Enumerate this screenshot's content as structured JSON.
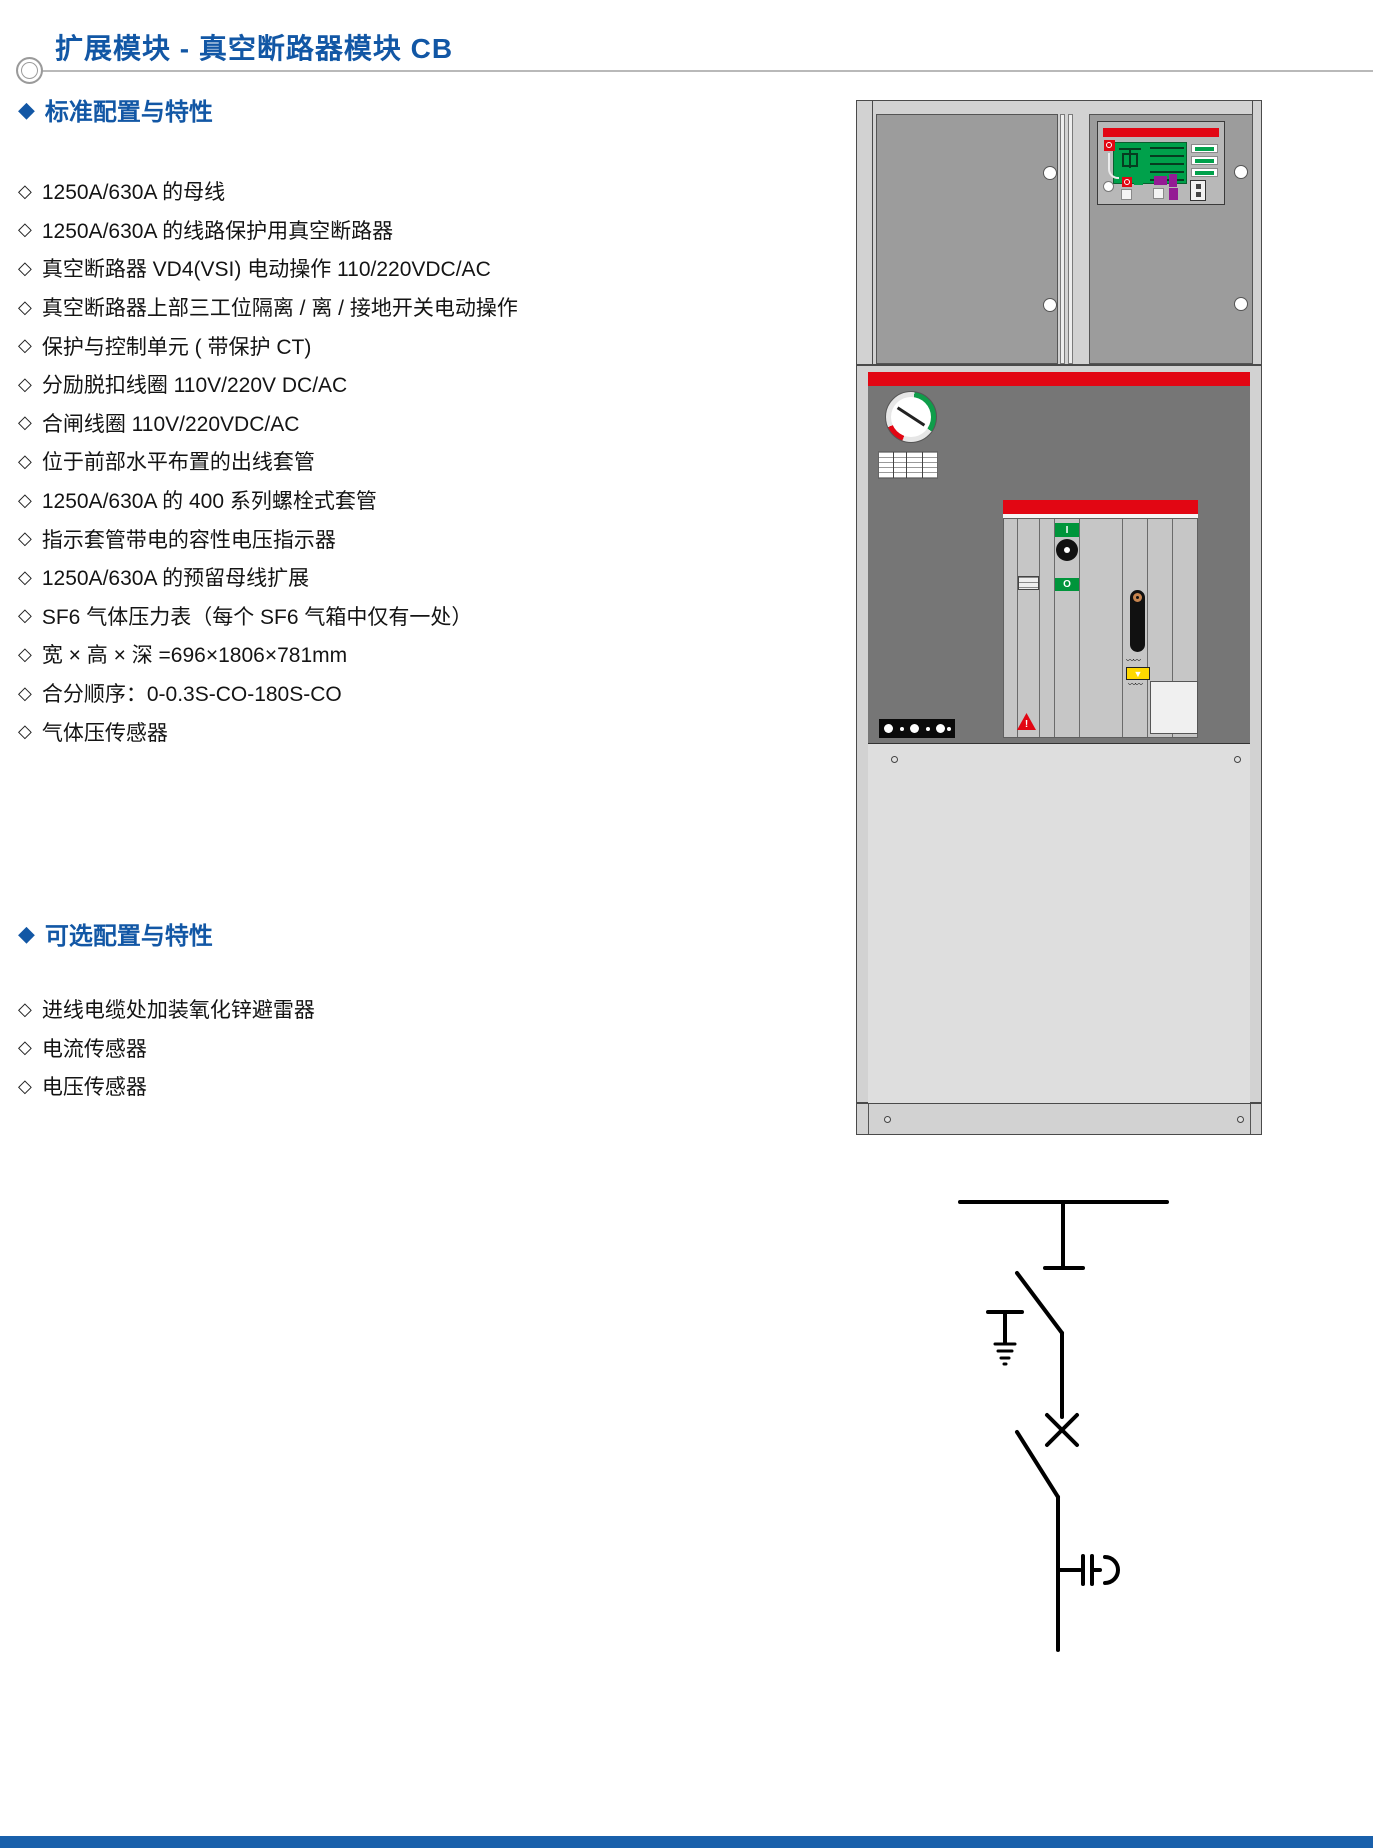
{
  "header": {
    "title": "扩展模块 - 真空断路器模块 CB"
  },
  "item_marker": "◇",
  "section_marker": "◆",
  "standard_section": {
    "heading": "标准配置与特性",
    "items": [
      "1250A/630A 的母线",
      "1250A/630A 的线路保护用真空断路器",
      "真空断路器 VD4(VSI) 电动操作 110/220VDC/AC",
      "真空断路器上部三工位隔离 / 离 / 接地开关电动操作",
      "保护与控制单元 ( 带保护 CT)",
      "分励脱扣线圈 110V/220V DC/AC",
      "合闸线圈 110V/220VDC/AC",
      "位于前部水平布置的出线套管",
      "1250A/630A 的 400 系列螺栓式套管",
      "指示套管带电的容性电压指示器",
      "1250A/630A 的预留母线扩展",
      "SF6 气体压力表（每个 SF6 气箱中仅有一处）",
      "宽 × 高 × 深 =696×1806×781mm",
      "合分顺序：0-0.3S-CO-180S-CO",
      "气体压传感器"
    ]
  },
  "optional_section": {
    "heading": "可选配置与特性",
    "items": [
      "进线电缆处加装氧化锌避雷器",
      "电流传感器",
      "电压传感器"
    ]
  },
  "cabinet": {
    "close_button_label": "I",
    "open_button_label": "O",
    "spring_arrow": "▼",
    "warning_mark": "!",
    "zigzag": "〰〰"
  },
  "colors": {
    "accent_blue": "#1257a5",
    "signal_red": "#e20613",
    "button_green": "#00953b",
    "warning_yellow": "#ffd800",
    "footer_blue": "#1960ab"
  }
}
